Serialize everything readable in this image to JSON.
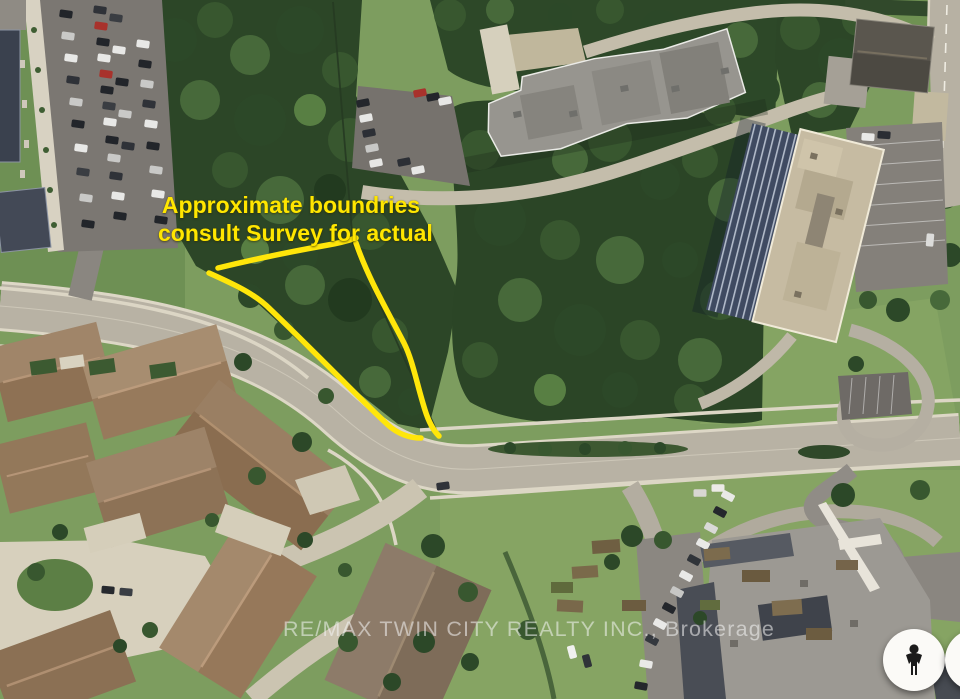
{
  "map": {
    "annotation": {
      "line1": "Approximate boundries",
      "line2": "consult Survey for actual"
    },
    "watermark": "RE/MAX TWIN CITY REALTY INC., Brokerage",
    "controls": {
      "pegman": {
        "icon": "pegman-icon"
      },
      "compass": {
        "icon": "compass-icon"
      }
    },
    "colors": {
      "boundary": "#FFE60A",
      "annotation_text": "#FFE600"
    }
  }
}
